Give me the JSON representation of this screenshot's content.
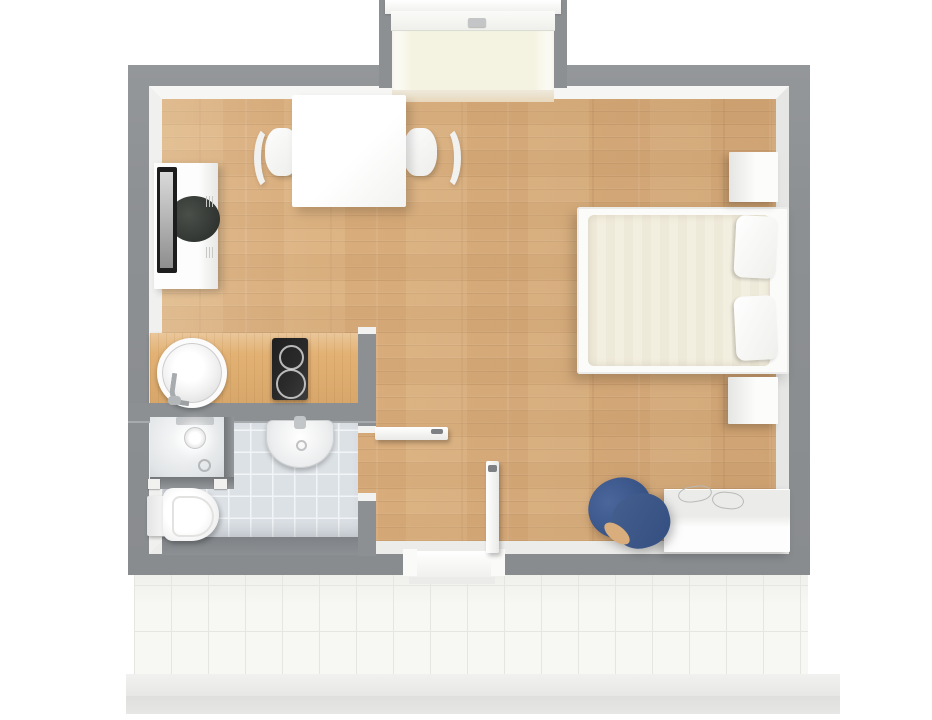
{
  "scene": {
    "title": "Studio apartment - 3D top-down floor plan",
    "background": "#ffffff"
  },
  "colors": {
    "wall": "#8d9093",
    "wall_face": "#f1f1ef",
    "wood_floor": "#d9ad7c",
    "counter_wood": "#e2b173",
    "bathroom_tile": "#dce1e6",
    "terrace_tile": "#f7f7f4",
    "window_sill": "#f4f3e1",
    "mattress": "#f3efe0",
    "armchair_blue": "#3a5588",
    "cooktop": "#2a2a2a",
    "tv": "#1d1d1d",
    "fixture_white": "#fbfbfb",
    "glass_gray": "#73777a"
  },
  "rooms": {
    "living": {
      "label": "Living / sleeping area",
      "floor": "wood plank"
    },
    "kitchenette": {
      "label": "Kitchenette",
      "floor": "wood plank"
    },
    "bathroom": {
      "label": "Bathroom",
      "floor": "grey tile"
    },
    "hall": {
      "label": "Entry hall",
      "floor": "wood plank"
    },
    "terrace": {
      "label": "Terrace",
      "floor": "white tile"
    },
    "alcove": {
      "label": "Window alcove",
      "floor": "cream sill"
    }
  },
  "furniture": {
    "dining_table": {
      "label": "Dining table"
    },
    "dining_chair_left": {
      "label": "Dining chair left"
    },
    "dining_chair_right": {
      "label": "Dining chair right"
    },
    "tv_cabinet": {
      "label": "TV cabinet"
    },
    "tv": {
      "label": "Television"
    },
    "bed": {
      "label": "Double bed"
    },
    "pillow_top": {
      "label": "Pillow"
    },
    "pillow_bottom": {
      "label": "Pillow"
    },
    "nightstand_top": {
      "label": "Nightstand"
    },
    "nightstand_bottom": {
      "label": "Nightstand"
    },
    "armchair": {
      "label": "Blue armchair"
    },
    "desk": {
      "label": "Desk sideboard"
    }
  },
  "fixtures": {
    "kitchen_counter": {
      "label": "Kitchen counter"
    },
    "kitchen_sink": {
      "label": "Round kitchen sink"
    },
    "cooktop": {
      "label": "Two-burner cooktop"
    },
    "shower": {
      "label": "Shower enclosure"
    },
    "shower_head": {
      "label": "Shower head"
    },
    "bathroom_sink": {
      "label": "Wash basin"
    },
    "toilet": {
      "label": "Toilet"
    }
  },
  "openings": {
    "window": {
      "label": "Window",
      "state": "closed"
    },
    "front_door": {
      "label": "Terrace entry door",
      "state": "open"
    },
    "bathroom_door": {
      "label": "Bathroom door",
      "state": "open"
    }
  }
}
